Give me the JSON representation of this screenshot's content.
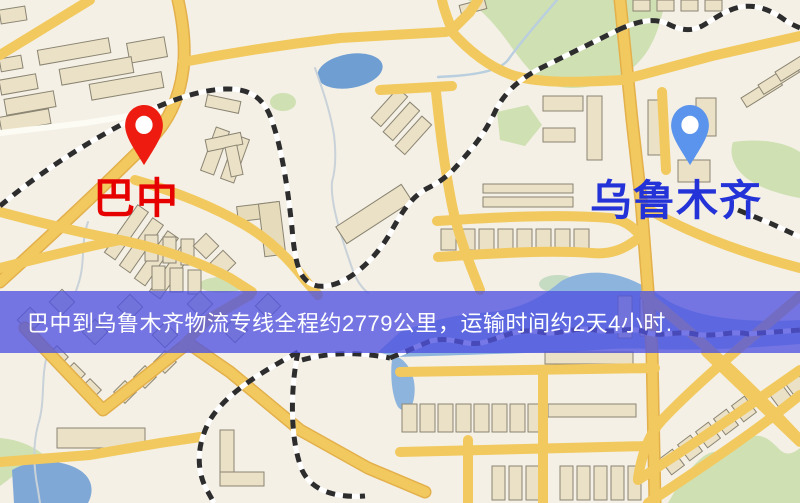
{
  "map": {
    "kind": "street-map-snapshot",
    "colors": {
      "background": "#f4f0e6",
      "road_major": "#f2c95e",
      "road_casing": "#e3b04b",
      "road_minor": "#fcfbf4",
      "building_fill": "#ebe1c6",
      "building_stroke": "#8a8472",
      "park": "#cfe0b2",
      "water": "#7fa8d6",
      "railway_dark": "#2d2d2d",
      "railway_light": "#ffffff"
    }
  },
  "markers": {
    "origin": {
      "label": "巴中",
      "pin_color": "#ee1c10",
      "pin_dot_color": "#ffffff",
      "label_color": "#e60000"
    },
    "destination": {
      "label": "乌鲁木齐",
      "pin_color": "#5b94ec",
      "pin_dot_color": "#ffffff",
      "label_color": "#2433d8"
    }
  },
  "banner": {
    "text": "巴中到乌鲁木齐物流专线全程约2779公里，运输时间约2天4小时.",
    "background_color": "rgba(80,82,224,0.78)",
    "text_color": "#ffffff"
  },
  "css_vars": {
    "--banner-bg": "rgba(80,82,224,0.78)",
    "--banner-text": "#ffffff",
    "--origin-pin": "#ee1c10",
    "--dest-pin": "#5b94ec",
    "--origin-label": "#e60000",
    "--dest-label": "#2433d8"
  }
}
